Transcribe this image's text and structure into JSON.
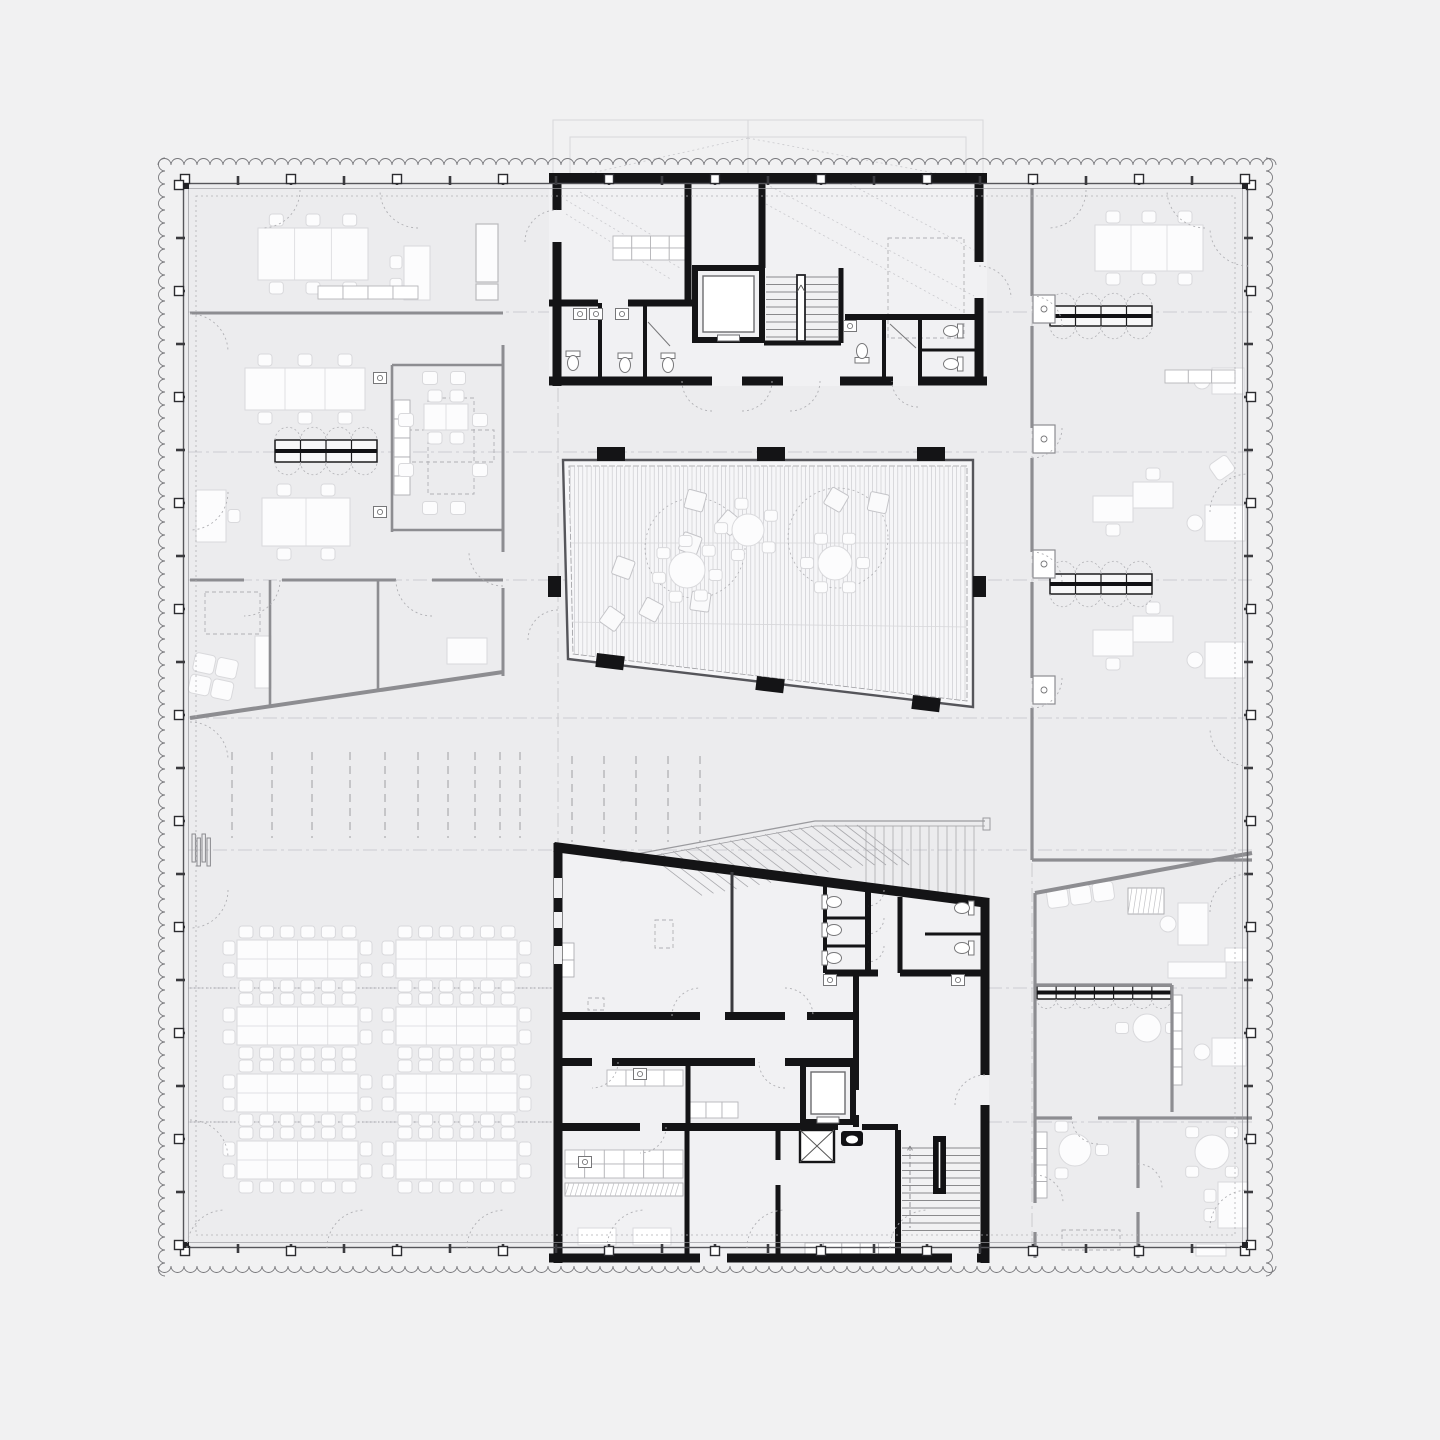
{
  "meta": {
    "drawing_type": "architectural-floor-plan",
    "text_labels": []
  },
  "palette": {
    "background": "#f1f1f2",
    "floor": "#ececee",
    "core_floor": "#f1f1f3",
    "atrium_fill": "#f6f6f8",
    "wall_black": "#141416",
    "wall_gray": "#8d8d91",
    "line_thin": "#55555a",
    "line_mid": "#9a9a9e",
    "line_faint": "#d7d7da",
    "hatch": "#c6c6ca",
    "dash": "#b0b0b4",
    "gridline": "#c2c2c7",
    "furniture_fill": "#fcfcfd",
    "furniture_stroke": "#d9d9dc",
    "fixture": "#777779",
    "locker_stroke": "#1c1c1e"
  },
  "perimeter": {
    "wall_rect": [
      183,
      183,
      1065,
      1065
    ],
    "second_rect": [
      188,
      188,
      1055,
      1055
    ],
    "dotted_rect": [
      196,
      196,
      1039,
      1039
    ],
    "zigzag": {
      "offset_out": 165,
      "offset_far": 1266,
      "period": 13,
      "radius": 6.5,
      "from": 158,
      "to": 1275
    },
    "tick_step": 53,
    "marker_step": 106,
    "span": [
      185,
      1245
    ]
  },
  "grid": {
    "h_lines": [
      312,
      452,
      580,
      718,
      850,
      988,
      1122
    ],
    "v_lines": [
      558,
      1032
    ]
  },
  "roof": {
    "outer": [
      553,
      120,
      430,
      63
    ],
    "inner": [
      570,
      137,
      396,
      46
    ]
  },
  "atrium": {
    "polygon": [
      [
        563,
        460
      ],
      [
        973,
        460
      ],
      [
        973,
        707
      ],
      [
        568,
        659
      ]
    ],
    "inner_polygon": [
      [
        569,
        466
      ],
      [
        967,
        466
      ],
      [
        967,
        701
      ],
      [
        573,
        654
      ]
    ],
    "hatch_step": 4.2,
    "columns_top": [
      597,
      757,
      917
    ],
    "columns_top_y": 447,
    "col_w": 28,
    "col_h": 14,
    "columns_bottom": [
      [
        597,
        653
      ],
      [
        757,
        676
      ],
      [
        913,
        695
      ]
    ],
    "bottom_rot": 6.8,
    "columns_side": [
      [
        548,
        576
      ],
      [
        973,
        576
      ]
    ],
    "side_w": 13,
    "side_h": 21,
    "circles": [
      [
        695,
        548,
        50
      ],
      [
        838,
        538,
        50
      ]
    ],
    "cushions": [
      [
        695,
        500,
        15
      ],
      [
        729,
        522,
        40
      ],
      [
        690,
        543,
        20
      ],
      [
        651,
        609,
        28
      ],
      [
        700,
        601,
        8
      ],
      [
        836,
        499,
        30
      ],
      [
        878,
        502,
        12
      ],
      [
        623,
        567,
        20
      ],
      [
        612,
        618,
        35
      ]
    ]
  },
  "tribune": {
    "rail": [
      [
        620,
        857
      ],
      [
        815,
        821
      ],
      [
        985,
        821
      ]
    ],
    "diag_treads": {
      "x0": 650,
      "x1": 858,
      "step": 11.5,
      "dx": 52,
      "dy": 40
    },
    "vert_treads": {
      "x0": 866,
      "x1": 982,
      "step": 9,
      "ytop": 826
    },
    "slope": {
      "x0": 558,
      "y0": 848,
      "k": 0.1288
    }
  },
  "furniture": {
    "conference_tables": [
      {
        "x": 258,
        "y": 228,
        "w": 110,
        "h": 52,
        "cols": 3,
        "ct": 3,
        "cb": 3
      },
      {
        "x": 245,
        "y": 368,
        "w": 120,
        "h": 42,
        "cols": 3,
        "ct": 3,
        "cb": 3
      },
      {
        "x": 424,
        "y": 404,
        "w": 44,
        "h": 26,
        "cols": 2,
        "ct": 2,
        "cb": 2
      },
      {
        "x": 262,
        "y": 498,
        "w": 88,
        "h": 48,
        "cols": 2,
        "ct": 2,
        "cb": 2
      },
      {
        "x": 1095,
        "y": 225,
        "w": 108,
        "h": 46,
        "cols": 3,
        "ct": 3,
        "cb": 3
      }
    ],
    "workstations": {
      "cols": [
        237,
        396
      ],
      "rows": [
        940,
        1007,
        1074,
        1141
      ],
      "w": 121,
      "h": 38,
      "chairs_long": 6,
      "chairs_end": 2
    },
    "round_tables": [
      {
        "cx": 687,
        "cy": 570,
        "r": 18,
        "chairs": 7,
        "a0": 10
      },
      {
        "cx": 748,
        "cy": 530,
        "r": 16,
        "chairs": 5,
        "a0": 40
      },
      {
        "cx": 835,
        "cy": 563,
        "r": 17,
        "chairs": 6,
        "a0": 0
      },
      {
        "cx": 1147,
        "cy": 1028,
        "r": 14,
        "chairs": 2,
        "a0": 180
      },
      {
        "cx": 1075,
        "cy": 1150,
        "r": 16,
        "chairs": 3,
        "a0": 120
      },
      {
        "cx": 1212,
        "cy": 1152,
        "r": 17,
        "chairs": 4,
        "a0": 45
      }
    ],
    "desks": [
      {
        "x": 404,
        "y": 246,
        "w": 26,
        "h": 54,
        "chairs": "left"
      },
      {
        "x": 196,
        "y": 490,
        "w": 30,
        "h": 52,
        "chairs": "right"
      },
      {
        "x": 1093,
        "y": 496,
        "w": 40,
        "h": 26,
        "chairs": "bottom"
      },
      {
        "x": 1133,
        "y": 482,
        "w": 40,
        "h": 26,
        "chairs": "top"
      },
      {
        "x": 1093,
        "y": 630,
        "w": 40,
        "h": 26,
        "chairs": "bottom"
      },
      {
        "x": 1133,
        "y": 616,
        "w": 40,
        "h": 26,
        "chairs": "top"
      },
      {
        "x": 1205,
        "y": 505,
        "w": 40,
        "h": 36,
        "chairs": "round"
      },
      {
        "x": 1205,
        "y": 642,
        "w": 40,
        "h": 36,
        "chairs": "round"
      },
      {
        "x": 1212,
        "y": 368,
        "w": 32,
        "h": 26,
        "chairs": "round"
      },
      {
        "x": 1178,
        "y": 903,
        "w": 30,
        "h": 42,
        "chairs": "round"
      },
      {
        "x": 1168,
        "y": 962,
        "w": 58,
        "h": 16,
        "chairs": "none"
      },
      {
        "x": 1212,
        "y": 1038,
        "w": 34,
        "h": 28,
        "chairs": "round"
      },
      {
        "x": 1218,
        "y": 1182,
        "w": 30,
        "h": 46,
        "chairs": "left"
      },
      {
        "x": 1196,
        "y": 1244,
        "w": 30,
        "h": 12,
        "chairs": "none"
      },
      {
        "x": 447,
        "y": 638,
        "w": 40,
        "h": 26,
        "chairs": "none"
      },
      {
        "x": 255,
        "y": 636,
        "w": 16,
        "h": 52,
        "chairs": "none"
      }
    ],
    "couches": [
      {
        "x": 196,
        "y": 652,
        "seats": 2,
        "rows": 2,
        "rot": 12
      },
      {
        "x": 1046,
        "y": 890,
        "seats": 3,
        "rows": 1,
        "rot": -8
      },
      {
        "x": 1208,
        "y": 466,
        "seats": 1,
        "rows": 1,
        "rot": -35
      }
    ],
    "cabinets": [
      [
        476,
        224,
        22,
        58
      ],
      [
        476,
        284,
        22,
        16
      ]
    ],
    "lockers": [
      {
        "x": 275,
        "y": 440,
        "w": 102,
        "h": 22,
        "cols": 4,
        "scallops": "both"
      },
      {
        "x": 1050,
        "y": 306,
        "w": 102,
        "h": 20,
        "cols": 4,
        "scallops": "both"
      },
      {
        "x": 1050,
        "y": 574,
        "w": 102,
        "h": 20,
        "cols": 4,
        "scallops": "both"
      },
      {
        "x": 1037,
        "y": 986,
        "w": 134,
        "h": 13,
        "cols": 7,
        "scallops": "below"
      }
    ],
    "shelves": [
      {
        "x": 1171,
        "y": 995,
        "w": 11,
        "h": 90,
        "n": 5
      },
      {
        "x": 1036,
        "y": 1132,
        "w": 11,
        "h": 66,
        "n": 4
      },
      {
        "x": 560,
        "y": 943,
        "w": 14,
        "h": 34,
        "n": 2
      },
      {
        "x": 394,
        "y": 400,
        "w": 16,
        "h": 95,
        "n": 5
      }
    ],
    "cell_rows": [
      {
        "x": 613,
        "y": 236,
        "w": 75,
        "h": 24,
        "cols": 4,
        "rows": 2
      },
      {
        "x": 607,
        "y": 1070,
        "w": 76,
        "h": 16,
        "cols": 4,
        "rows": 1
      },
      {
        "x": 690,
        "y": 1102,
        "w": 48,
        "h": 16,
        "cols": 3,
        "rows": 1
      },
      {
        "x": 565,
        "y": 1150,
        "w": 118,
        "h": 28,
        "cols": 6,
        "rows": 2
      },
      {
        "x": 805,
        "y": 1243,
        "w": 92,
        "h": 11,
        "cols": 5,
        "rows": 1
      },
      {
        "x": 318,
        "y": 286,
        "w": 100,
        "h": 13,
        "cols": 4,
        "rows": 1
      },
      {
        "x": 1165,
        "y": 370,
        "w": 70,
        "h": 13,
        "cols": 3,
        "rows": 1
      }
    ],
    "counter_hatch": [
      [
        565,
        1183,
        118,
        13
      ],
      [
        1128,
        888,
        36,
        26
      ]
    ],
    "white_tables": [
      [
        578,
        1228,
        38,
        17
      ],
      [
        633,
        1228,
        38,
        17
      ],
      [
        1225,
        948,
        22,
        14
      ]
    ],
    "meeting_chairs": [
      [
        430,
        378
      ],
      [
        458,
        378
      ],
      [
        430,
        508
      ],
      [
        458,
        508
      ],
      [
        406,
        420
      ],
      [
        406,
        470
      ],
      [
        480,
        420
      ],
      [
        480,
        470
      ]
    ],
    "radiator": {
      "x": 192,
      "y": 834
    }
  },
  "fixtures": {
    "wcs": [
      [
        573,
        362,
        0
      ],
      [
        625,
        364,
        0
      ],
      [
        668,
        364,
        0
      ],
      [
        862,
        352,
        180
      ],
      [
        952,
        331,
        90
      ],
      [
        952,
        364,
        90
      ],
      [
        833,
        902,
        270
      ],
      [
        833,
        930,
        270
      ],
      [
        833,
        958,
        270
      ],
      [
        963,
        908,
        90
      ],
      [
        963,
        948,
        90
      ]
    ],
    "sinks": [
      [
        580,
        314
      ],
      [
        596,
        314
      ],
      [
        622,
        314
      ],
      [
        850,
        326
      ],
      [
        830,
        980
      ],
      [
        958,
        980
      ],
      [
        380,
        378
      ],
      [
        380,
        512
      ],
      [
        640,
        1074
      ],
      [
        585,
        1162
      ]
    ],
    "showers": [
      [
        648,
        322,
        670,
        346
      ],
      [
        890,
        324,
        916,
        348
      ]
    ],
    "niches_y": [
      295,
      425,
      550,
      676
    ]
  },
  "cores": {
    "top_floor": [
      549,
      173,
      438,
      213
    ],
    "bottom_floor": [
      [
        554,
        847
      ],
      [
        989,
        903
      ],
      [
        989,
        1263
      ],
      [
        554,
        1263
      ]
    ],
    "window_slots": [
      [
        554,
        878,
        8,
        20
      ],
      [
        554,
        912,
        8,
        16
      ],
      [
        554,
        946,
        8,
        18
      ]
    ],
    "elevators": [
      {
        "x": 695,
        "y": 268,
        "w": 67,
        "h": 72
      },
      {
        "x": 803,
        "y": 1064,
        "w": 50,
        "h": 58
      }
    ],
    "shaft": {
      "x": 800,
      "y": 1130,
      "w": 34,
      "h": 32
    },
    "grease": {
      "x": 841,
      "y": 1131,
      "w": 22,
      "h": 15
    },
    "stair_top": {
      "x0": 766,
      "x1": 838,
      "y0": 277,
      "y1": 341,
      "step": 7.5,
      "rail": [
        797,
        275,
        8,
        66
      ]
    },
    "stair_bottom": {
      "x0": 902,
      "x1": 980,
      "y0": 1148,
      "y1": 1232,
      "step": 7.5,
      "bar": [
        933,
        1136,
        13,
        58
      ]
    }
  },
  "marks": {
    "groupA": {
      "xs": [
        232,
        272,
        312,
        350,
        385,
        418,
        448,
        475,
        500,
        520
      ],
      "y0": 752,
      "y1": 838
    },
    "groupB": {
      "xs": [
        572,
        604,
        636,
        668,
        700
      ],
      "y0": 756,
      "y1": 842
    },
    "dotted_rows": [
      {
        "y": 988,
        "x0": 190,
        "x1": 552
      },
      {
        "y": 1122,
        "x0": 190,
        "x1": 552
      }
    ]
  },
  "dashed_rects": [
    [
      888,
      238,
      76,
      100
    ],
    [
      428,
      398,
      46,
      96
    ],
    [
      408,
      430,
      86,
      32
    ],
    [
      655,
      920,
      18,
      28
    ],
    [
      588,
      998,
      16,
      12
    ],
    [
      1062,
      1230,
      58,
      20
    ],
    [
      205,
      592,
      55,
      42
    ]
  ],
  "dashed_diagonals": [
    [
      566,
      200,
      680,
      268
    ],
    [
      566,
      214,
      672,
      280
    ],
    [
      580,
      192,
      680,
      252
    ],
    [
      766,
      184,
      974,
      296
    ],
    [
      766,
      204,
      960,
      310
    ],
    [
      850,
      184,
      974,
      250
    ],
    [
      748,
      138,
      560,
      180
    ],
    [
      748,
      138,
      972,
      180
    ]
  ],
  "door_arcs": [
    [
      262,
      190,
      38,
      0,
      90
    ],
    [
      418,
      190,
      38,
      90,
      180
    ],
    [
      1048,
      190,
      38,
      0,
      90
    ],
    [
      1205,
      190,
      38,
      90,
      180
    ],
    [
      190,
      352,
      38,
      270,
      360
    ],
    [
      190,
      492,
      38,
      0,
      90
    ],
    [
      190,
      760,
      38,
      270,
      360
    ],
    [
      190,
      890,
      38,
      0,
      90
    ],
    [
      190,
      1158,
      38,
      270,
      360
    ],
    [
      1248,
      228,
      38,
      90,
      180
    ],
    [
      1248,
      512,
      38,
      180,
      270
    ],
    [
      1248,
      728,
      38,
      90,
      180
    ],
    [
      1248,
      912,
      38,
      180,
      270
    ],
    [
      1248,
      1228,
      38,
      180,
      270
    ],
    [
      225,
      1248,
      38,
      180,
      270
    ],
    [
      365,
      1248,
      38,
      180,
      270
    ],
    [
      505,
      1248,
      38,
      180,
      270
    ],
    [
      645,
      1248,
      38,
      180,
      270
    ],
    [
      785,
      1248,
      38,
      180,
      270
    ],
    [
      928,
      1248,
      38,
      180,
      270
    ],
    [
      244,
      580,
      36,
      0,
      90
    ],
    [
      432,
      580,
      36,
      90,
      180
    ],
    [
      503,
      552,
      34,
      90,
      180
    ],
    [
      557,
      242,
      32,
      180,
      270
    ],
    [
      979,
      298,
      32,
      270,
      360
    ],
    [
      712,
      381,
      30,
      90,
      180
    ],
    [
      742,
      381,
      30,
      0,
      90
    ],
    [
      790,
      381,
      30,
      0,
      90
    ],
    [
      918,
      381,
      26,
      90,
      180
    ],
    [
      700,
      1016,
      28,
      180,
      270
    ],
    [
      785,
      1016,
      28,
      270,
      360
    ],
    [
      592,
      1062,
      26,
      0,
      90
    ],
    [
      785,
      1062,
      26,
      90,
      180
    ],
    [
      640,
      1127,
      26,
      0,
      90
    ],
    [
      1032,
      326,
      30,
      270,
      360
    ],
    [
      1032,
      428,
      30,
      0,
      90
    ],
    [
      1032,
      582,
      30,
      270,
      360
    ],
    [
      1032,
      678,
      30,
      0,
      90
    ],
    [
      1098,
      1118,
      26,
      90,
      180
    ],
    [
      1035,
      1203,
      28,
      270,
      360
    ],
    [
      1138,
      1188,
      24,
      270,
      360
    ],
    [
      558,
      640,
      30,
      180,
      270
    ],
    [
      985,
      1105,
      30,
      180,
      270
    ],
    [
      868,
      918,
      16,
      0,
      90
    ],
    [
      868,
      946,
      16,
      0,
      90
    ],
    [
      868,
      890,
      16,
      0,
      90
    ]
  ]
}
